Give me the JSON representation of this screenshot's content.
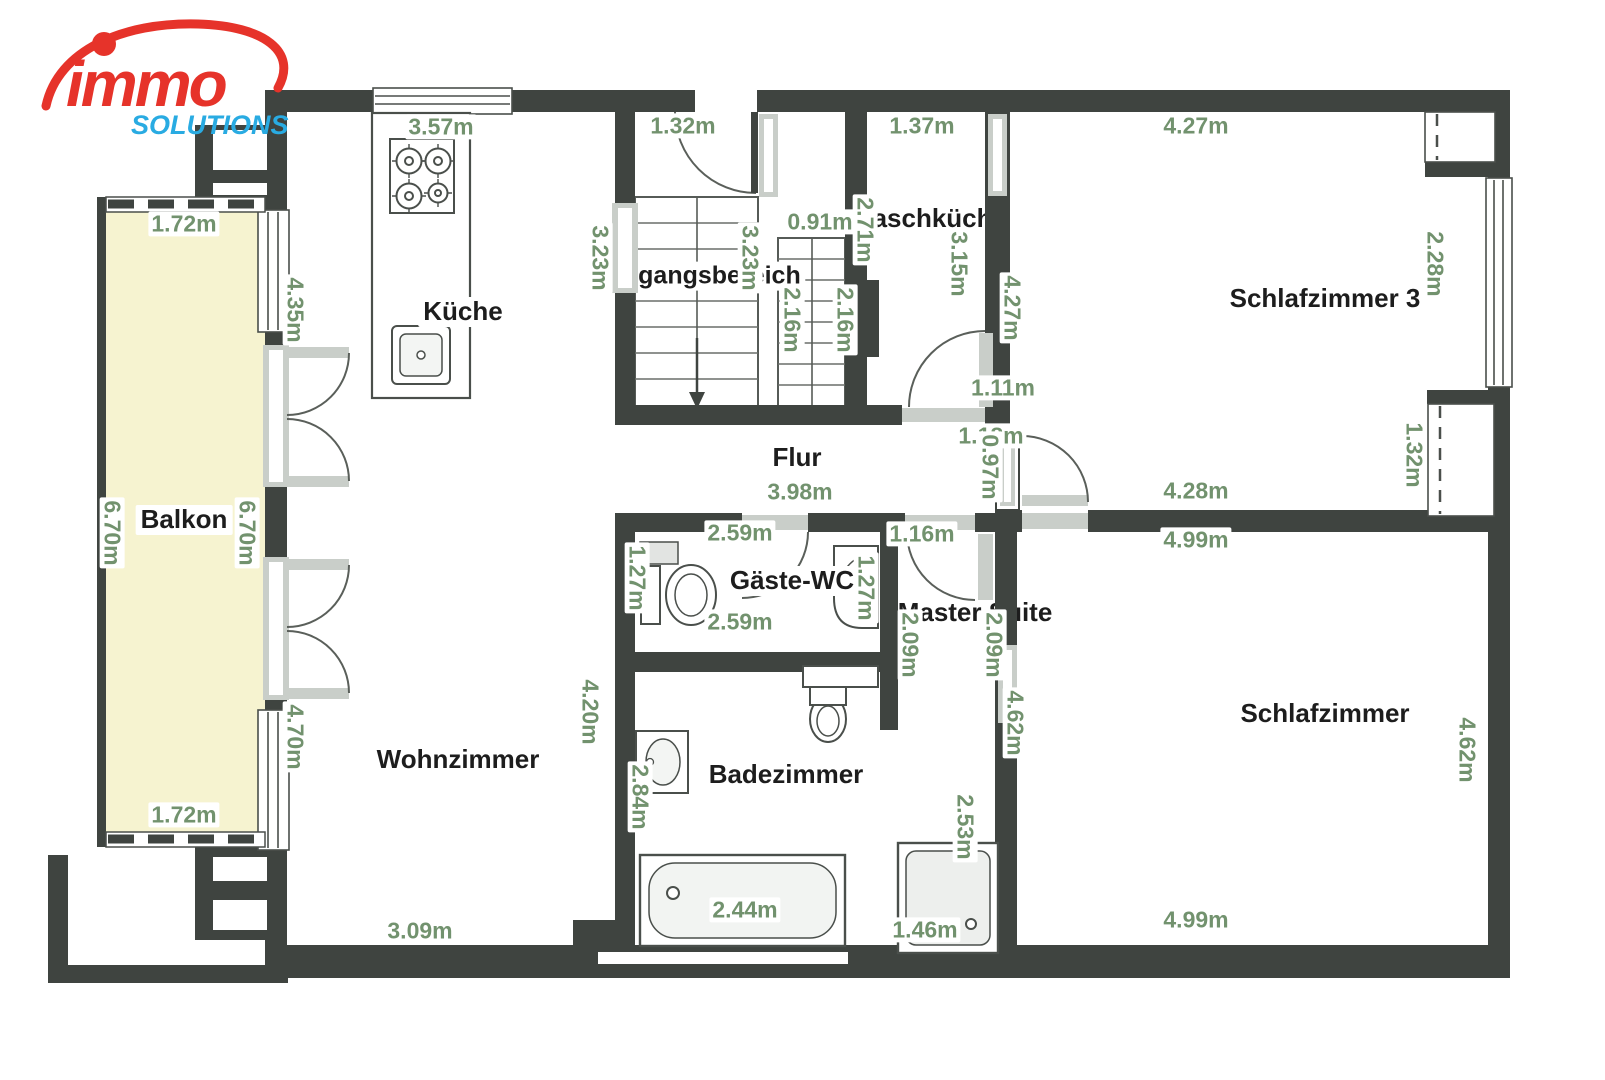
{
  "brand": {
    "name": "immo",
    "tagline": "SOLUTIONS",
    "name_color": "#e6332a",
    "tagline_color": "#29abe2"
  },
  "colors": {
    "wall": "#3f4440",
    "window_band": "#c9cec9",
    "balcony_fill": "#f6f3d0",
    "dimension_text": "#72926e",
    "room_text": "#1d1d1d",
    "fixture_outline": "#4a4f4b"
  },
  "rooms": [
    {
      "id": "kueche",
      "label": "Küche"
    },
    {
      "id": "balkon",
      "label": "Balkon"
    },
    {
      "id": "eingangsbereich",
      "label": "Eingangsbereich"
    },
    {
      "id": "waschkueche",
      "label": "Waschküche"
    },
    {
      "id": "schlafzimmer-3",
      "label": "Schlafzimmer 3"
    },
    {
      "id": "flur",
      "label": "Flur"
    },
    {
      "id": "gaeste-wc",
      "label": "Gäste-WC"
    },
    {
      "id": "master-suite",
      "label": "Master Suite"
    },
    {
      "id": "wohnzimmer",
      "label": "Wohnzimmer"
    },
    {
      "id": "badezimmer",
      "label": "Badezimmer"
    },
    {
      "id": "schlafzimmer",
      "label": "Schlafzimmer"
    }
  ],
  "dimensions": [
    {
      "text": "3.57m"
    },
    {
      "text": "1.32m"
    },
    {
      "text": "1.37m"
    },
    {
      "text": "4.27m"
    },
    {
      "text": "1.72m"
    },
    {
      "text": "0.91m"
    },
    {
      "text": "1.11m"
    },
    {
      "text": "1.18m"
    },
    {
      "text": "4.28m"
    },
    {
      "text": "3.98m"
    },
    {
      "text": "2.59m"
    },
    {
      "text": "1.16m"
    },
    {
      "text": "4.99m"
    },
    {
      "text": "2.59m"
    },
    {
      "text": "1.72m"
    },
    {
      "text": "2.44m"
    },
    {
      "text": "1.46m"
    },
    {
      "text": "3.09m"
    },
    {
      "text": "4.99m"
    },
    {
      "text": "4.35m"
    },
    {
      "text": "3.23m"
    },
    {
      "text": "3.23m"
    },
    {
      "text": "2.71m"
    },
    {
      "text": "3.15m"
    },
    {
      "text": "4.27m"
    },
    {
      "text": "2.16m"
    },
    {
      "text": "2.16m"
    },
    {
      "text": "2.28m"
    },
    {
      "text": "0.97m"
    },
    {
      "text": "1.32m"
    },
    {
      "text": "6.70m"
    },
    {
      "text": "6.70m"
    },
    {
      "text": "1.27m"
    },
    {
      "text": "1.27m"
    },
    {
      "text": "2.09m"
    },
    {
      "text": "2.09m"
    },
    {
      "text": "4.62m"
    },
    {
      "text": "4.62m"
    },
    {
      "text": "4.70m"
    },
    {
      "text": "4.20m"
    },
    {
      "text": "2.84m"
    },
    {
      "text": "2.53m"
    }
  ]
}
